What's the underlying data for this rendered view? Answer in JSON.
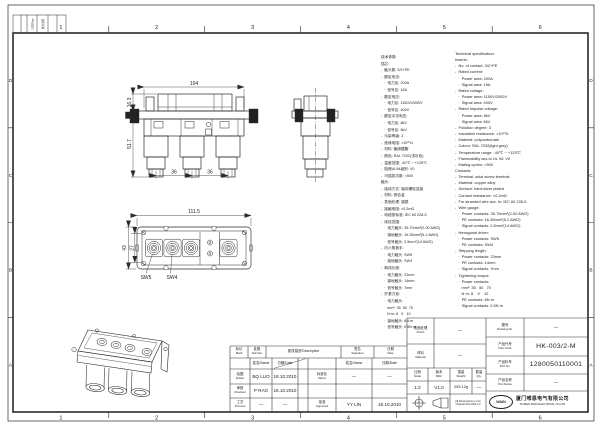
{
  "border": {
    "cols": [
      "1",
      "2",
      "3",
      "4",
      "5",
      "6"
    ],
    "rows": [
      "D",
      "C",
      "B",
      "A"
    ],
    "rev_strip": [
      "日期/Date",
      "更改说明"
    ]
  },
  "views": {
    "front": {
      "dim_width": "104",
      "dim_cover_h": "16.3",
      "dim_body_h": "51.7",
      "dim_pitch": "36"
    },
    "plan": {
      "dim_width": "111.5",
      "dim_outer_h": "43",
      "dim_inner_h": "27",
      "sw5": "SW5",
      "sw4": "SW4"
    }
  },
  "spec_cn": [
    "技术参数:",
    "插芯:",
    "-  触头数: 3/2+PE",
    "-  额定电流:",
    "   ·  电力区: 200A",
    "   ·  信号区: 16A",
    "-  额定电压:",
    "   ·  电力区: 1150V/2000V",
    "   ·  信号区: 400V",
    "-  额定冲击电压:",
    "   ·  电力区: 8kV",
    "   ·  信号区: 6kV",
    "-  污染等级: 3",
    "-  绝缘电阻: >10¹⁰Ω",
    "-  材料: 聚碳酸酯",
    "-  颜色: RAL 7032(浅灰色)",
    "-  温度范围: -40℃ ~ +125℃",
    "-  阻燃UL94级别: V0",
    "-  可插拔次数: >500",
    "触头:",
    "-  接线方式: 轴向螺栓连接",
    "-  材料: 铜合金",
    "-  表面处理: 镀银",
    "-  接触电阻: <0.2mΩ",
    "-  电缆按标准: IEC 60 228-5",
    "-  线径范围:",
    "   ·  电力触头: 35-70mm²(2-00 AWG)",
    "   ·  接地触头: 16-35mm²(5-2 AWG)",
    "   ·  信号触头: 2.5mm²(14 AWG)",
    "-  内六角扳手:",
    "   ·  电力触头: SW5",
    "   ·  接地触头: SW4",
    "-  剥线长度:",
    "   ·  电力触头: 22mm",
    "   ·  接地触头: 14mm",
    "   ·  信号触头: 7mm",
    "-  拧紧力矩:",
    "   ·  电力触头:",
    "      mm²: 35  50  70",
    "      N·m: 8   9   10",
    "   ·  接地触头: 6N·m",
    "   ·  信号触头: 0.5N·m"
  ],
  "spec_en": [
    "Technical specification:",
    "Inserts:",
    "-  No. of contact: 3/2+PE",
    "-  Rated current:",
    "   ·  Power area: 200A",
    "   ·  Signal area: 16A",
    "-  Rated voltage:",
    "   ·  Power area: 1150V/2000V",
    "   ·  Signal area: 400V",
    "-  Rated impulse voltage:",
    "   ·  Power area: 8kV",
    "   ·  Signal area: 6kV",
    "-  Pollution degree: 3",
    "-  Insulation resistance: >10¹⁰Ω",
    "-  Material: polycarbonate",
    "-  Colour: RAL 7032(light grey)",
    "-  Temperature range: -40℃ ~ +125℃",
    "-  Flammability acc.to UL 94: V0",
    "-  Mating cycles: >500",
    "Contacts:",
    "-  Terminal: axial screw terminal",
    "-  Material: copper alloy",
    "-  Surface: hard-silver plated",
    "-  Contact resistance: <0.2mΩ",
    "-  For stranded wire acc. to: IEC 60 228-5",
    "-  Wire gauge:",
    "   ·  Power contacts: 35-70mm²(2-00 AWG)",
    "   ·  PE contacts: 16-35mm²(5-2 AWG)",
    "   ·  Signal contacts: 2.5mm²(14 AWG)",
    "-  Hexagonal driver:",
    "   ·  Power contacts: SW5",
    "   ·  PE contacts: SW4",
    "-  Stripping length:",
    "   ·  Power contacts: 23mm",
    "   ·  PE contacts: 14mm",
    "   ·  Signal contacts: 7mm",
    "-  Tightening torque:",
    "   ·  Power contacts:",
    "      mm²: 35   50   70",
    "      N·m: 8    9    10",
    "   ·  PE contacts: 6N·m",
    "   ·  Signal contacts: 0.5N·m"
  ],
  "title_block": {
    "rev_header": {
      "mark_cn": "标记",
      "mark_en": "Mark",
      "number_cn": "处数",
      "number_en": "Number",
      "description": "更改描述/Description",
      "signature_cn": "签名",
      "signature_en": "Signature",
      "date_cn": "日期",
      "date_en": "Date"
    },
    "name_header": "姓名/Name",
    "date_header": "日期/Date",
    "drawn": {
      "cn": "绘图",
      "en": "Drawn",
      "name": "BQ LUO",
      "date": "18.10.2010"
    },
    "checked": {
      "cn": "审核",
      "en": "Checked",
      "name": "P RAO",
      "date": "18.10.2010"
    },
    "process": {
      "cn": "工艺",
      "en": "Process",
      "name": "—",
      "date": "—"
    },
    "stand": {
      "cn": "标准化",
      "en": "Stand.",
      "name": "—",
      "date": "—"
    },
    "approved": {
      "cn": "批准",
      "en": "Approved",
      "name": "YY LIN",
      "date": "18.10.2010"
    },
    "finish": {
      "cn": "表面处理",
      "en": "Finish",
      "value": "—"
    },
    "material": {
      "cn": "材料",
      "en": "Material",
      "value": "—"
    },
    "scale": {
      "cn": "比例",
      "en": "Scale",
      "value": "1:2"
    },
    "rev": {
      "cn": "版本",
      "en": "REV.",
      "value": "V1.0"
    },
    "weight": {
      "cn": "重量",
      "en": "Weight",
      "value": "293.12g"
    },
    "qty": {
      "cn": "数量",
      "en": "Qty.",
      "value": "—"
    },
    "drawing_no": {
      "cn": "图号",
      "en": "Drawing No.",
      "value": "—"
    },
    "part_code": {
      "cn": "产品代号",
      "en": "Part Code",
      "value": "HK-003/2-M"
    },
    "part_no": {
      "cn": "产品料号",
      "en": "Port No.",
      "value": "1280050110001"
    },
    "part_name": {
      "cn": "产品名称",
      "en": "Port Name",
      "value": "—"
    },
    "dimensions_note": [
      "All Dimensions in mm",
      "Original Size DIN A 4"
    ],
    "company": {
      "logo": "WAIN",
      "name_cn": "厦门唯恩电气有限公司",
      "name_en": "XIAMEN WAIN ELECTRICAL CO.LTD"
    }
  }
}
